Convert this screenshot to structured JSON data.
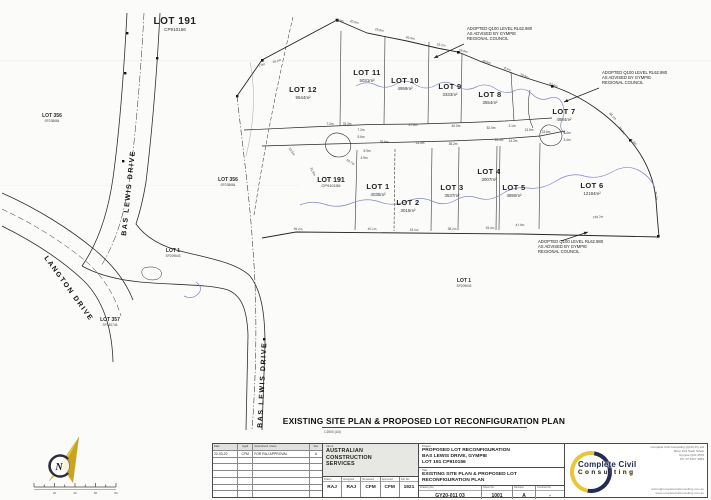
{
  "page": {
    "ink": "#2e2e2e",
    "creek_color": "#8088c2",
    "accent_yellow": "#e8c636",
    "accent_navy": "#232c52"
  },
  "plan": {
    "title": "EXISTING SITE PLAN & PROPOSED LOT RECONFIGURATION PLAN",
    "title_scale": "1:2000  (A3)",
    "flood_note_lines": [
      "ADOPTED Q100 LEVEL RL62.980",
      "AS ADVISED BY GYMPIE",
      "REGIONAL COUNCIL"
    ],
    "flood_notes": [
      {
        "x": 467,
        "y": 30,
        "lx1": 464,
        "ly1": 44,
        "lx2": 434,
        "ly2": 58
      },
      {
        "x": 602,
        "y": 74,
        "lx1": 599,
        "ly1": 88,
        "lx2": 564,
        "ly2": 102
      },
      {
        "x": 538,
        "y": 243,
        "lx1": 561,
        "ly1": 241,
        "lx2": 588,
        "ly2": 232
      }
    ],
    "street_labels": [
      {
        "label": "BAS LEWIS DRIVE",
        "x": 126,
        "y": 236,
        "r": -84
      },
      {
        "label": "LANGTON DRIVE",
        "x": 44,
        "y": 258,
        "r": 54
      },
      {
        "label": "BAS LEWIS DRIVE",
        "x": 262,
        "y": 428,
        "r": -87
      }
    ],
    "proposed_lots": [
      {
        "name": "LOT 12",
        "area": "9544m²",
        "x": 303,
        "y": 92
      },
      {
        "name": "LOT 11",
        "area": "5031m²",
        "x": 367,
        "y": 75
      },
      {
        "name": "LOT 10",
        "area": "4959m²",
        "x": 405,
        "y": 83
      },
      {
        "name": "LOT 9",
        "area": "3333m²",
        "x": 450,
        "y": 89
      },
      {
        "name": "LOT 8",
        "area": "3554m²",
        "x": 490,
        "y": 97
      },
      {
        "name": "LOT 7",
        "area": "4984m²",
        "x": 564,
        "y": 114
      },
      {
        "name": "LOT 1",
        "area": "4035m²",
        "x": 378,
        "y": 189
      },
      {
        "name": "LOT 2",
        "area": "3015m²",
        "x": 408,
        "y": 205
      },
      {
        "name": "LOT 3",
        "area": "3537m²",
        "x": 452,
        "y": 190
      },
      {
        "name": "LOT 4",
        "area": "3007m²",
        "x": 489,
        "y": 174
      },
      {
        "name": "LOT 5",
        "area": "4890m²",
        "x": 514,
        "y": 190
      },
      {
        "name": "LOT 6",
        "area": "12184m²",
        "x": 592,
        "y": 188
      }
    ],
    "existing_parcels": [
      {
        "name": "LOT 191",
        "plan": "CP910156",
        "x": 175,
        "y": 24,
        "s": "lg"
      },
      {
        "name": "LOT 356",
        "plan": "SP238664",
        "x": 52,
        "y": 117,
        "s": "sm"
      },
      {
        "name": "LOT 356",
        "plan": "SP238664",
        "x": 228,
        "y": 181,
        "s": "sm"
      },
      {
        "name": "LOT 191",
        "plan": "CP910156",
        "x": 331,
        "y": 182,
        "s": "md"
      },
      {
        "name": "LOT 1",
        "plan": "SP209643",
        "x": 173,
        "y": 252,
        "s": "sm"
      },
      {
        "name": "LOT 357",
        "plan": "SP182746",
        "x": 110,
        "y": 321,
        "s": "sm"
      },
      {
        "name": "LOT 1",
        "plan": "SP209643",
        "x": 464,
        "y": 282,
        "s": "sm"
      }
    ],
    "dimensions": [
      {
        "t": "7.0m",
        "x": 262,
        "y": 66,
        "r": -20
      },
      {
        "t": "19.1m",
        "x": 277,
        "y": 62,
        "r": -15
      },
      {
        "t": "16.1m",
        "x": 339,
        "y": 21,
        "r": 18
      },
      {
        "t": "20.0m",
        "x": 354,
        "y": 23,
        "r": 14
      },
      {
        "t": "29.9m",
        "x": 379,
        "y": 31,
        "r": 13
      },
      {
        "t": "49.4m",
        "x": 410,
        "y": 39,
        "r": 11
      },
      {
        "t": "53.2m",
        "x": 441,
        "y": 46,
        "r": 9
      },
      {
        "t": "29.9m",
        "x": 463,
        "y": 52,
        "r": 12
      },
      {
        "t": "49.5m",
        "x": 486,
        "y": 63,
        "r": 17
      },
      {
        "t": "8.4m",
        "x": 507,
        "y": 70,
        "r": 21
      },
      {
        "t": "29.9m",
        "x": 524,
        "y": 77,
        "r": 21
      },
      {
        "t": "63.2m",
        "x": 553,
        "y": 86,
        "r": 21
      },
      {
        "t": "84.1m",
        "x": 612,
        "y": 117,
        "r": 47
      },
      {
        "t": "35.0m",
        "x": 621,
        "y": 131,
        "r": 55
      },
      {
        "t": "2.0m",
        "x": 633,
        "y": 143,
        "r": 40
      },
      {
        "t": "76.7m",
        "x": 655,
        "y": 196,
        "r": 82
      },
      {
        "t": "7.2m",
        "x": 330,
        "y": 125,
        "r": 0
      },
      {
        "t": "78.3m",
        "x": 347,
        "y": 125,
        "r": 0
      },
      {
        "t": "47.8m",
        "x": 413,
        "y": 126,
        "r": 0
      },
      {
        "t": "40.0m",
        "x": 456,
        "y": 127,
        "r": 0
      },
      {
        "t": "52.0m",
        "x": 491,
        "y": 129,
        "r": 0
      },
      {
        "t": "3.1m",
        "x": 512,
        "y": 127,
        "r": 0
      },
      {
        "t": "13.5m",
        "x": 529,
        "y": 131,
        "r": 0
      },
      {
        "t": "23.6m",
        "x": 546,
        "y": 133,
        "r": 0
      },
      {
        "t": "28.6m",
        "x": 384,
        "y": 143,
        "r": 0
      },
      {
        "t": "33.5m",
        "x": 420,
        "y": 144,
        "r": 0
      },
      {
        "t": "38.2m",
        "x": 453,
        "y": 145,
        "r": 0
      },
      {
        "t": "14.5m",
        "x": 499,
        "y": 141,
        "r": 0
      },
      {
        "t": "14.2m",
        "x": 513,
        "y": 142,
        "r": 0
      },
      {
        "t": "5.4m",
        "x": 567,
        "y": 134,
        "r": 0
      },
      {
        "t": "3.4m",
        "x": 567,
        "y": 141,
        "r": 0
      },
      {
        "t": "7.2m",
        "x": 361,
        "y": 131,
        "r": 0
      },
      {
        "t": "5.6m",
        "x": 361,
        "y": 138,
        "r": 0
      },
      {
        "t": "5.9m",
        "x": 367,
        "y": 152,
        "r": 0
      },
      {
        "t": "4.9m",
        "x": 364,
        "y": 159,
        "r": 0
      },
      {
        "t": "50.7m",
        "x": 350,
        "y": 163,
        "r": 33
      },
      {
        "t": "31.9m",
        "x": 312,
        "y": 172,
        "r": 64
      },
      {
        "t": "52.5m",
        "x": 291,
        "y": 152,
        "r": 55
      },
      {
        "t": "69.2m",
        "x": 298,
        "y": 230,
        "r": 3
      },
      {
        "t": "45.1m",
        "x": 372,
        "y": 230,
        "r": 2
      },
      {
        "t": "33.5m",
        "x": 414,
        "y": 231,
        "r": 2
      },
      {
        "t": "38.2m",
        "x": 452,
        "y": 230,
        "r": 2
      },
      {
        "t": "33.4m",
        "x": 490,
        "y": 229,
        "r": 1
      },
      {
        "t": "47.9m",
        "x": 520,
        "y": 226,
        "r": -2
      },
      {
        "t": "139.7m",
        "x": 598,
        "y": 218,
        "r": -3
      }
    ],
    "scale_bar_labels": [
      "20",
      "40",
      "60",
      "80"
    ]
  },
  "title_block": {
    "revision_table": {
      "headers": [
        "Date",
        "Appd",
        "Amendment / Issue",
        "Rev"
      ],
      "rows": [
        {
          "date": "22-03-22",
          "approved": "CFM",
          "description": "FOR RAJ APPROVAL",
          "rev": "A"
        }
      ]
    },
    "client": {
      "label": "Client",
      "lines": [
        "AUSTRALIAN",
        "CONSTRUCTION",
        "SERVICES"
      ]
    },
    "personnel": [
      {
        "label": "Drawn",
        "value": "RAJ"
      },
      {
        "label": "Designed",
        "value": "RAJ"
      },
      {
        "label": "Reviewed",
        "value": "CFM"
      },
      {
        "label": "Approved",
        "value": "CFM"
      },
      {
        "label": "Job No.",
        "value": "1921"
      }
    ],
    "project": {
      "label": "Project",
      "lines": [
        "PROPOSED LOT RECONFIGURATION",
        "BAS LEWIS DRIVE, GYMPIE",
        "LOT 191 CP910156"
      ]
    },
    "sheet_title": {
      "label": "Title",
      "lines": [
        "EXISTING SITE PLAN & PROPOSED LOT",
        "RECONFIGURATION PLAN"
      ]
    },
    "stamp": {
      "drawing_no_label": "Drawing No.",
      "drawing_no": "GY20-011 03",
      "sheet_label": "Sheet No.",
      "sheet": "1001",
      "revision_label": "Revision",
      "revision": "A",
      "contract_label": "Contract No.",
      "contract": "-"
    },
    "company": {
      "wordmark_line1": "Complete Civil",
      "wordmark_line2": "Consulting",
      "details": [
        "Complete Civil Consulting (QLD) Pty Ltd",
        "Shop 1/21 Nash Street",
        "Gympie QLD 4570",
        "Ph. 07 5417 4053"
      ],
      "links": [
        "admin@completecivilconsulting.com.au",
        "www.completecivilconsulting.com.au"
      ]
    }
  }
}
